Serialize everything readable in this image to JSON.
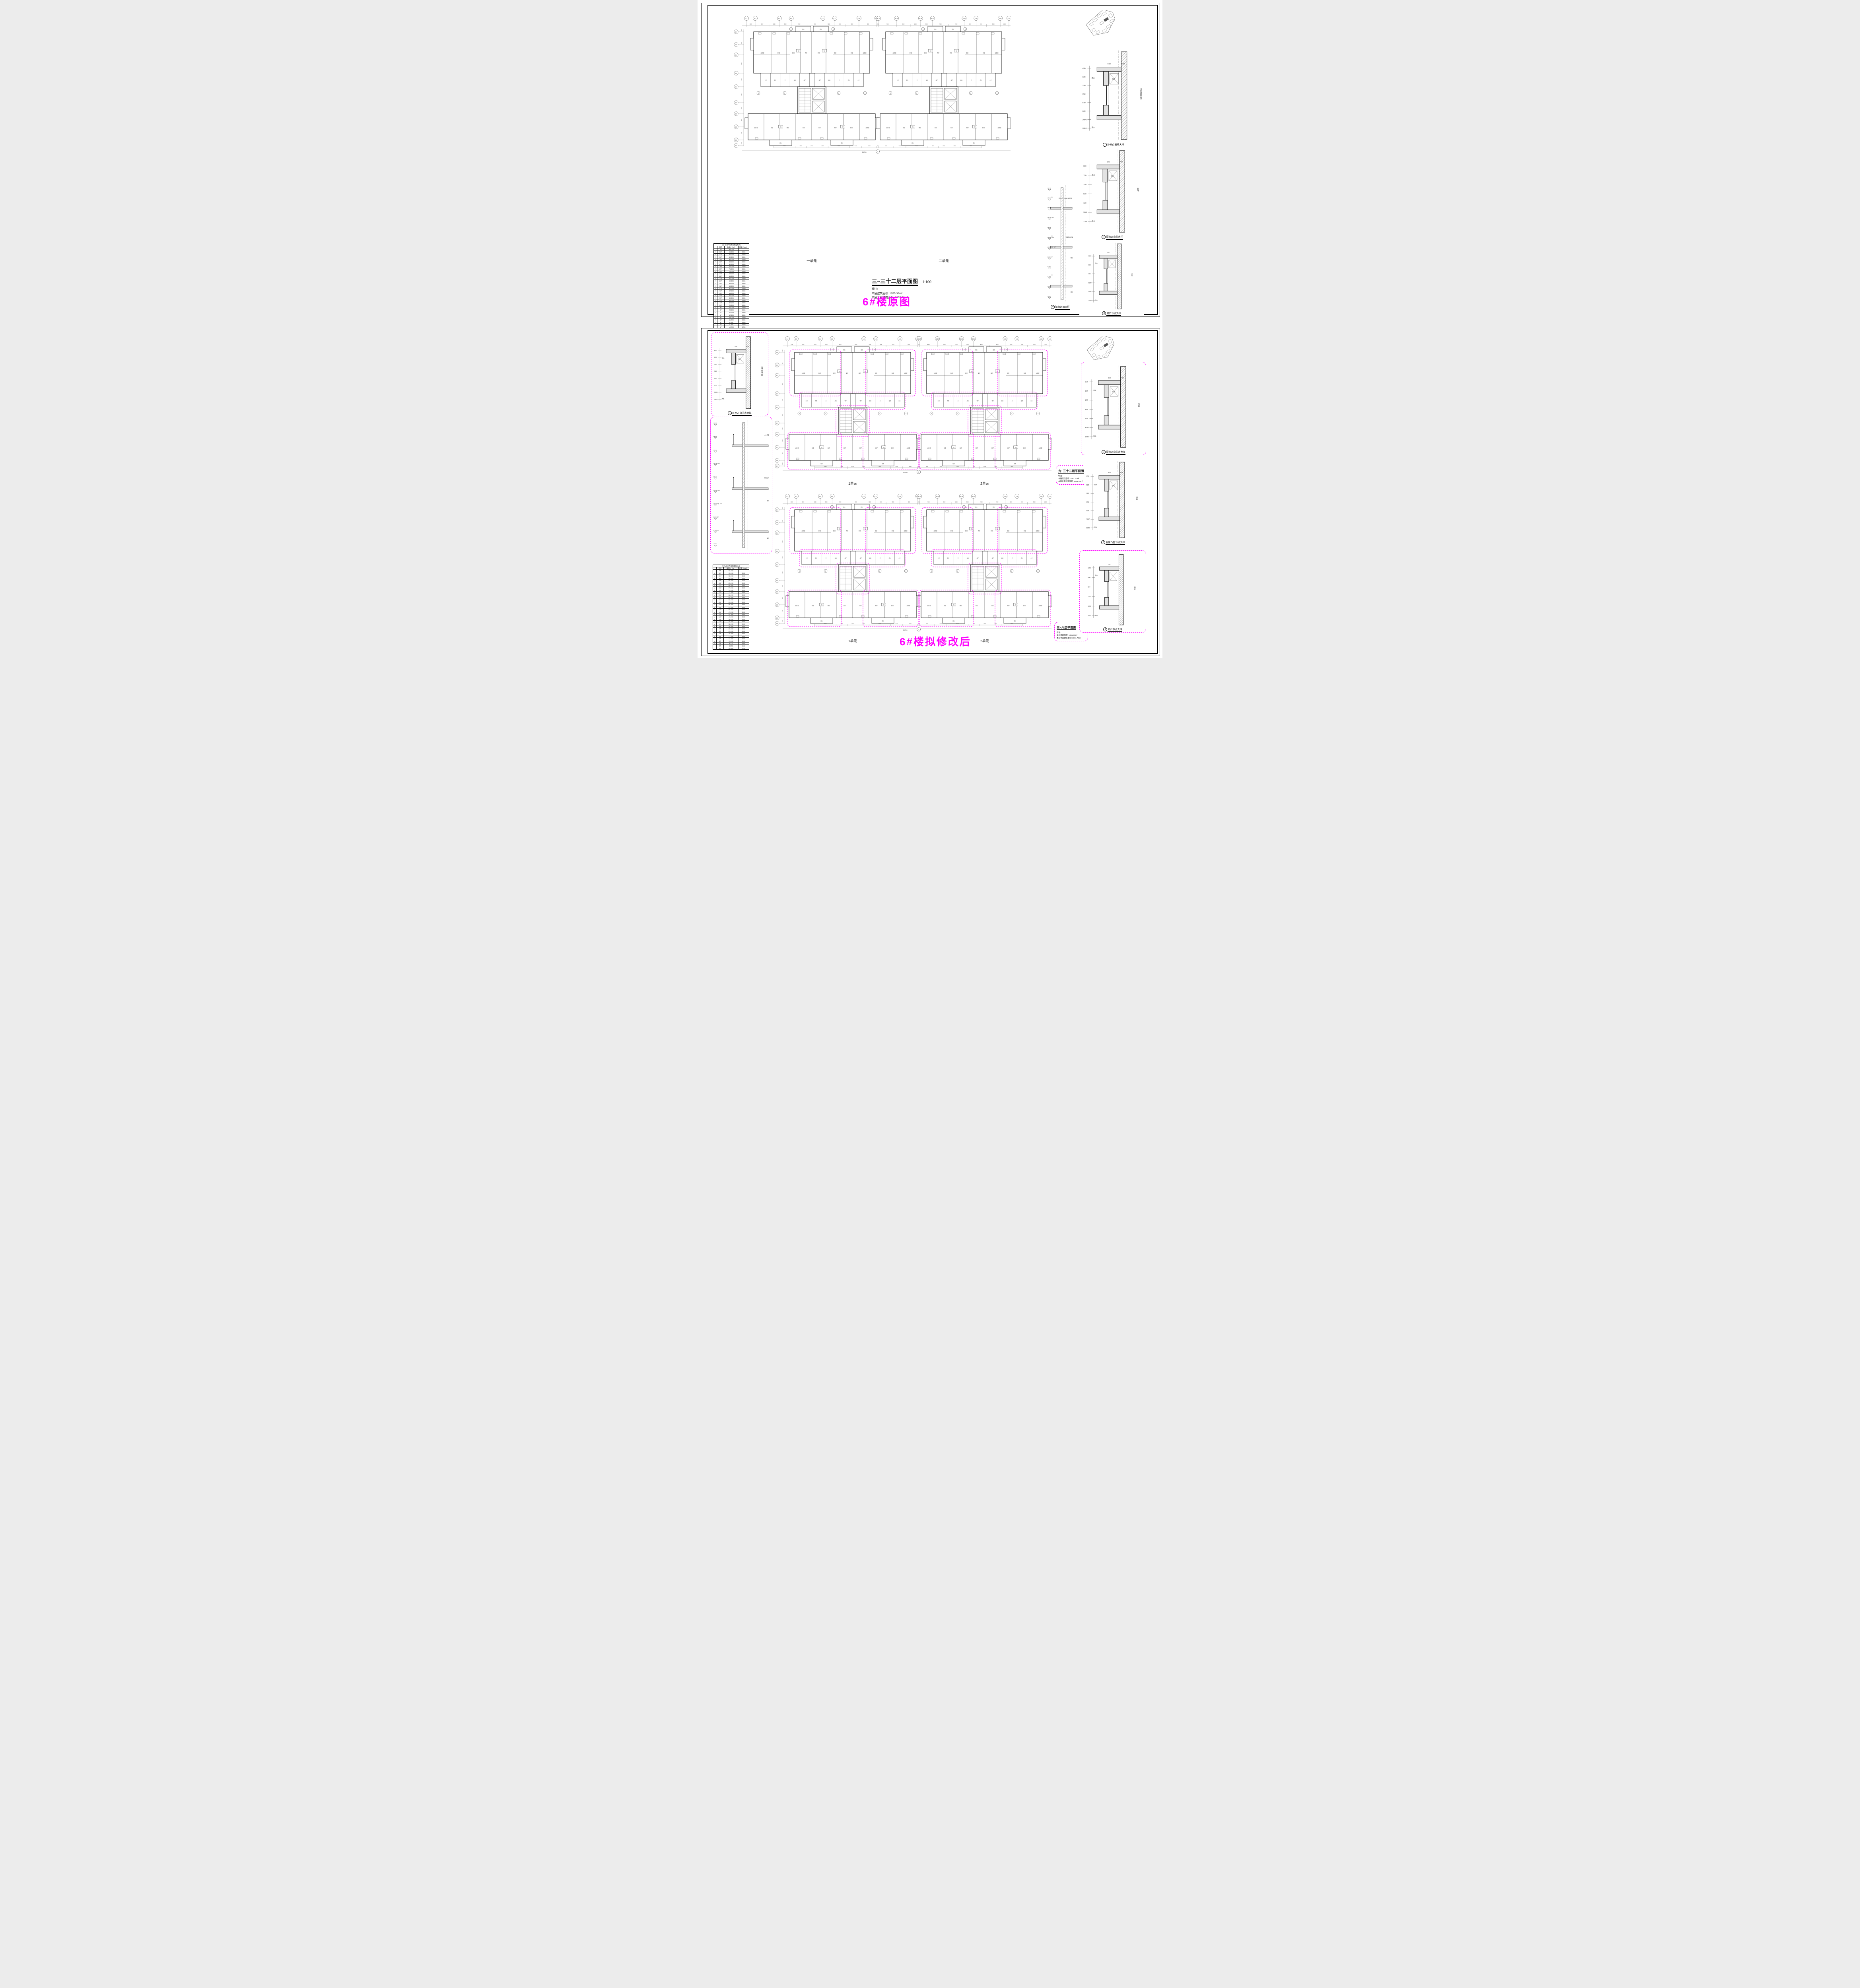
{
  "doc": {
    "bg": "#ffffff",
    "magenta": "#ff00ff",
    "line": "#111111"
  },
  "sheet1": {
    "annotation": "6#楼原图",
    "plan": {
      "title": "三~三十二层平面图",
      "scale": "1:100",
      "notes": [
        "标注:",
        "本层建筑面积: 1055.36m²",
        "本层计容建筑面积: 1055.36m²"
      ],
      "unit_labels": [
        "一单元",
        "二单元"
      ]
    },
    "details": [
      {
        "no": "1",
        "title": "卧室凸窗节大样"
      },
      {
        "no": "2",
        "title": "厨房凸窗节大样"
      },
      {
        "no": "4",
        "title": "阳台剖面大样"
      },
      {
        "no": "3",
        "title": "阳台节点大样"
      }
    ]
  },
  "sheet2": {
    "annotation": "6#楼拟修改后",
    "plans": [
      {
        "title": "九~三十二层平面图",
        "scale": "1:100",
        "notes": [
          "标注:",
          "本层建筑面积: 1061.70m²",
          "本层计容建筑面积: 1061.70m²"
        ],
        "unit_labels": [
          "1单元",
          "2单元"
        ]
      },
      {
        "title": "三~八层平面图",
        "scale": "1:100",
        "notes": [
          "标注:",
          "本层建筑面积: 1061.70m²",
          "本层计容建筑面积: 1061.70m²"
        ],
        "unit_labels": [
          "1单元",
          "2单元"
        ]
      }
    ],
    "details_left": [
      {
        "no": "1",
        "title": "卧室凸窗节点大样"
      }
    ],
    "details_right": [
      {
        "no": "2",
        "title": "厨房凸窗节点大样"
      },
      {
        "no": "4",
        "title": "厨房凸窗节点大样"
      },
      {
        "no": "3",
        "title": "阳台节点大样"
      }
    ]
  },
  "floor_table": {
    "note": "注: 标高H为本图楼层标高",
    "headers": [
      "",
      "层号",
      "标高H（m）",
      "层高（mm）"
    ],
    "rows": [
      [
        "",
        "RF",
        "98.200",
        ""
      ],
      [
        "✓",
        "32F",
        "95.200",
        "3000"
      ],
      [
        "✓",
        "31F",
        "92.200",
        "3000"
      ],
      [
        "✓",
        "30F",
        "89.200",
        "3000"
      ],
      [
        "✓",
        "29F",
        "86.200",
        "3000"
      ],
      [
        "✓",
        "28F",
        "83.200",
        "3000"
      ],
      [
        "✓",
        "27F",
        "80.200",
        "3000"
      ],
      [
        "✓",
        "26F",
        "77.200",
        "3000"
      ],
      [
        "✓",
        "25F",
        "74.200",
        "3000"
      ],
      [
        "✓",
        "24F",
        "71.200",
        "3000"
      ],
      [
        "✓",
        "23F",
        "68.200",
        "3000"
      ],
      [
        "✓",
        "22F",
        "65.200",
        "3000"
      ],
      [
        "✓",
        "21F",
        "62.200",
        "3000"
      ],
      [
        "✓",
        "20F",
        "59.200",
        "3000"
      ],
      [
        "✓",
        "19F",
        "56.200",
        "3000"
      ],
      [
        "✓",
        "18F",
        "53.200",
        "3000"
      ],
      [
        "✓",
        "17F",
        "50.200",
        "3000"
      ],
      [
        "✓",
        "16F",
        "47.200",
        "3000"
      ],
      [
        "✓",
        "15F",
        "44.200",
        "3000"
      ],
      [
        "✓",
        "14F",
        "41.200",
        "3000"
      ],
      [
        "✓",
        "13F",
        "38.200",
        "3000"
      ],
      [
        "✓",
        "12F",
        "35.200",
        "3000"
      ],
      [
        "✓",
        "11F",
        "32.200",
        "3000"
      ],
      [
        "✓",
        "10F",
        "29.200",
        "3000"
      ],
      [
        "✓",
        "9F",
        "26.200",
        "3000"
      ],
      [
        "✓",
        "8F",
        "23.200",
        "3000"
      ],
      [
        "✓",
        "7F",
        "20.200",
        "3000"
      ],
      [
        "✓",
        "6F",
        "17.200",
        "3000"
      ],
      [
        "✓",
        "5F",
        "14.200",
        "3000"
      ],
      [
        "✓",
        "4F",
        "11.200",
        "3000"
      ],
      [
        "✓",
        "3F",
        "8.200",
        "3000"
      ],
      [
        "",
        "2F",
        "5.200",
        "3000"
      ],
      [
        "",
        "1F",
        "±0.000",
        "5200"
      ]
    ]
  },
  "plan_common": {
    "overall_dim": "66250",
    "grid_labels": [
      "6-1",
      "6-2",
      "6-6",
      "6-8",
      "6-15",
      "6-17",
      "6-20",
      "6-22",
      "6-23",
      "6-25",
      "6-29",
      "6-31",
      "6-38",
      "6-40",
      "6-43",
      "6-45"
    ],
    "grid_labels_left": [
      "6-N",
      "6-M",
      "6-L",
      "6-K",
      "6-J",
      "6-F",
      "6-E",
      "6-D",
      "6-B",
      "6-A"
    ],
    "dims_top": [
      "2200",
      "3500",
      "2600",
      "3000",
      "4000",
      "4000",
      "3000",
      "2600",
      "3500",
      "4500",
      "450",
      "4500",
      "3500",
      "2600",
      "3000",
      "4000",
      "4000",
      "3000",
      "2600",
      "3500",
      "2200"
    ],
    "dims_bottom": [
      "5400",
      "2800",
      "2700",
      "2800",
      "5400",
      "3100",
      "3800",
      "450",
      "3800",
      "3100",
      "5400",
      "2800",
      "2700",
      "2800",
      "5400"
    ],
    "dims_left": [
      "1300",
      "800",
      "4800",
      "1700",
      "1600",
      "1500",
      "4800",
      "800",
      "2700",
      "1300",
      "3600",
      "1500"
    ],
    "rooms_upper": [
      "主卧室",
      "卧室",
      "卧室",
      "客厅",
      "客厅",
      "卧室",
      "卧室",
      "主卧室"
    ],
    "rooms_mid": [
      "主卫",
      "阳台",
      "卫",
      "厨房",
      "餐厅",
      "餐厅",
      "厨房",
      "卫",
      "阳台",
      "主卫"
    ],
    "rooms_lower": [
      "主卧室",
      "卧室",
      "餐厅",
      "客厅",
      "客厅",
      "餐厅",
      "卧室",
      "主卧室"
    ],
    "balcony": "阳台",
    "core_label": "电梯厅",
    "unit_numbers": [
      "01",
      "02",
      "03",
      "04"
    ],
    "section_marks": [
      "1",
      "2",
      "3",
      "5"
    ]
  },
  "details_data": {
    "bay": {
      "dims": [
        "450",
        "120",
        "330",
        "750",
        "630",
        "120",
        "3000",
        "1800"
      ],
      "top_dims": [
        "550",
        "500"
      ],
      "room": "主卧室(卧室)",
      "drip": "滴水",
      "louver": "百叶"
    },
    "kitchen": {
      "dims": [
        "650",
        "120",
        "180",
        "630",
        "120",
        "3000",
        "1300"
      ],
      "top_dims": [
        "600",
        "700"
      ],
      "room": "厨房",
      "drip": "滴水",
      "louver": "百叶"
    },
    "balcony": {
      "dims": [
        "1150",
        "600",
        "550",
        "1250",
        "1150",
        "3000"
      ],
      "top_dims": [
        "200"
      ],
      "room": "阳台",
      "drip": "滴水",
      "louver": ""
    },
    "section1": {
      "elevations": [
        "99.700",
        "98.650",
        "98.450",
        "98.200 (RF)",
        "98.150",
        "95.200 (33F)",
        "@3.000 (5~32F)",
        "8.200 (4F)",
        "6.350",
        "5.300",
        "5.050",
        "4.800"
      ],
      "labels": [
        "阳台上方（非女儿墙范围）",
        "局部阳台栏板",
        "阳台",
        "客厅"
      ]
    },
    "section2": {
      "elevations": [
        "99.800",
        "98.650",
        "98.450",
        "98.200 (RF)",
        "98.150",
        "95.200 (32F)",
        "@3.000 (5~31F)",
        "8.200 (3F)",
        "5.200 (2F)",
        "4.550"
      ],
      "labels": [
        "上人屋面",
        "玻璃栏杆",
        "阳台",
        "客厅"
      ]
    }
  }
}
